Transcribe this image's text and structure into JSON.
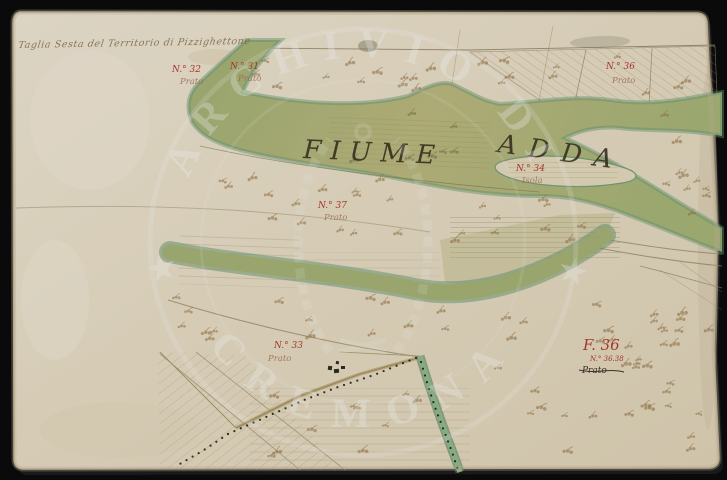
{
  "photo": {
    "background_color": "#0a0a0b",
    "paper_color": "#d6ccb8"
  },
  "inscription": {
    "text": "Taglia Sesta del Territorio di Pizzighettone"
  },
  "river": {
    "name_part1": "FIUME",
    "name_part2": "ADDA"
  },
  "labels": [
    {
      "num": "N.° 32",
      "sub": "Prato"
    },
    {
      "num": "N.° 31",
      "sub": "Prato"
    },
    {
      "num": "N.° 36",
      "sub": "Prato"
    },
    {
      "num": "N.° 34",
      "sub": "Isola"
    },
    {
      "num": "N.° 37",
      "sub": "Prato"
    },
    {
      "num": "N.° 33",
      "sub": "Prato"
    }
  ],
  "folio": {
    "main": "F. 36",
    "sub": "N.° 36.38",
    "note": "Prato"
  },
  "watermark": {
    "arc_top": "ARCHIVIO DI",
    "arc_bottom": "CREMONA",
    "star": "★"
  },
  "ink": {
    "red": "#a5362c",
    "black": "#332b1c",
    "brown": "#7a6443"
  }
}
